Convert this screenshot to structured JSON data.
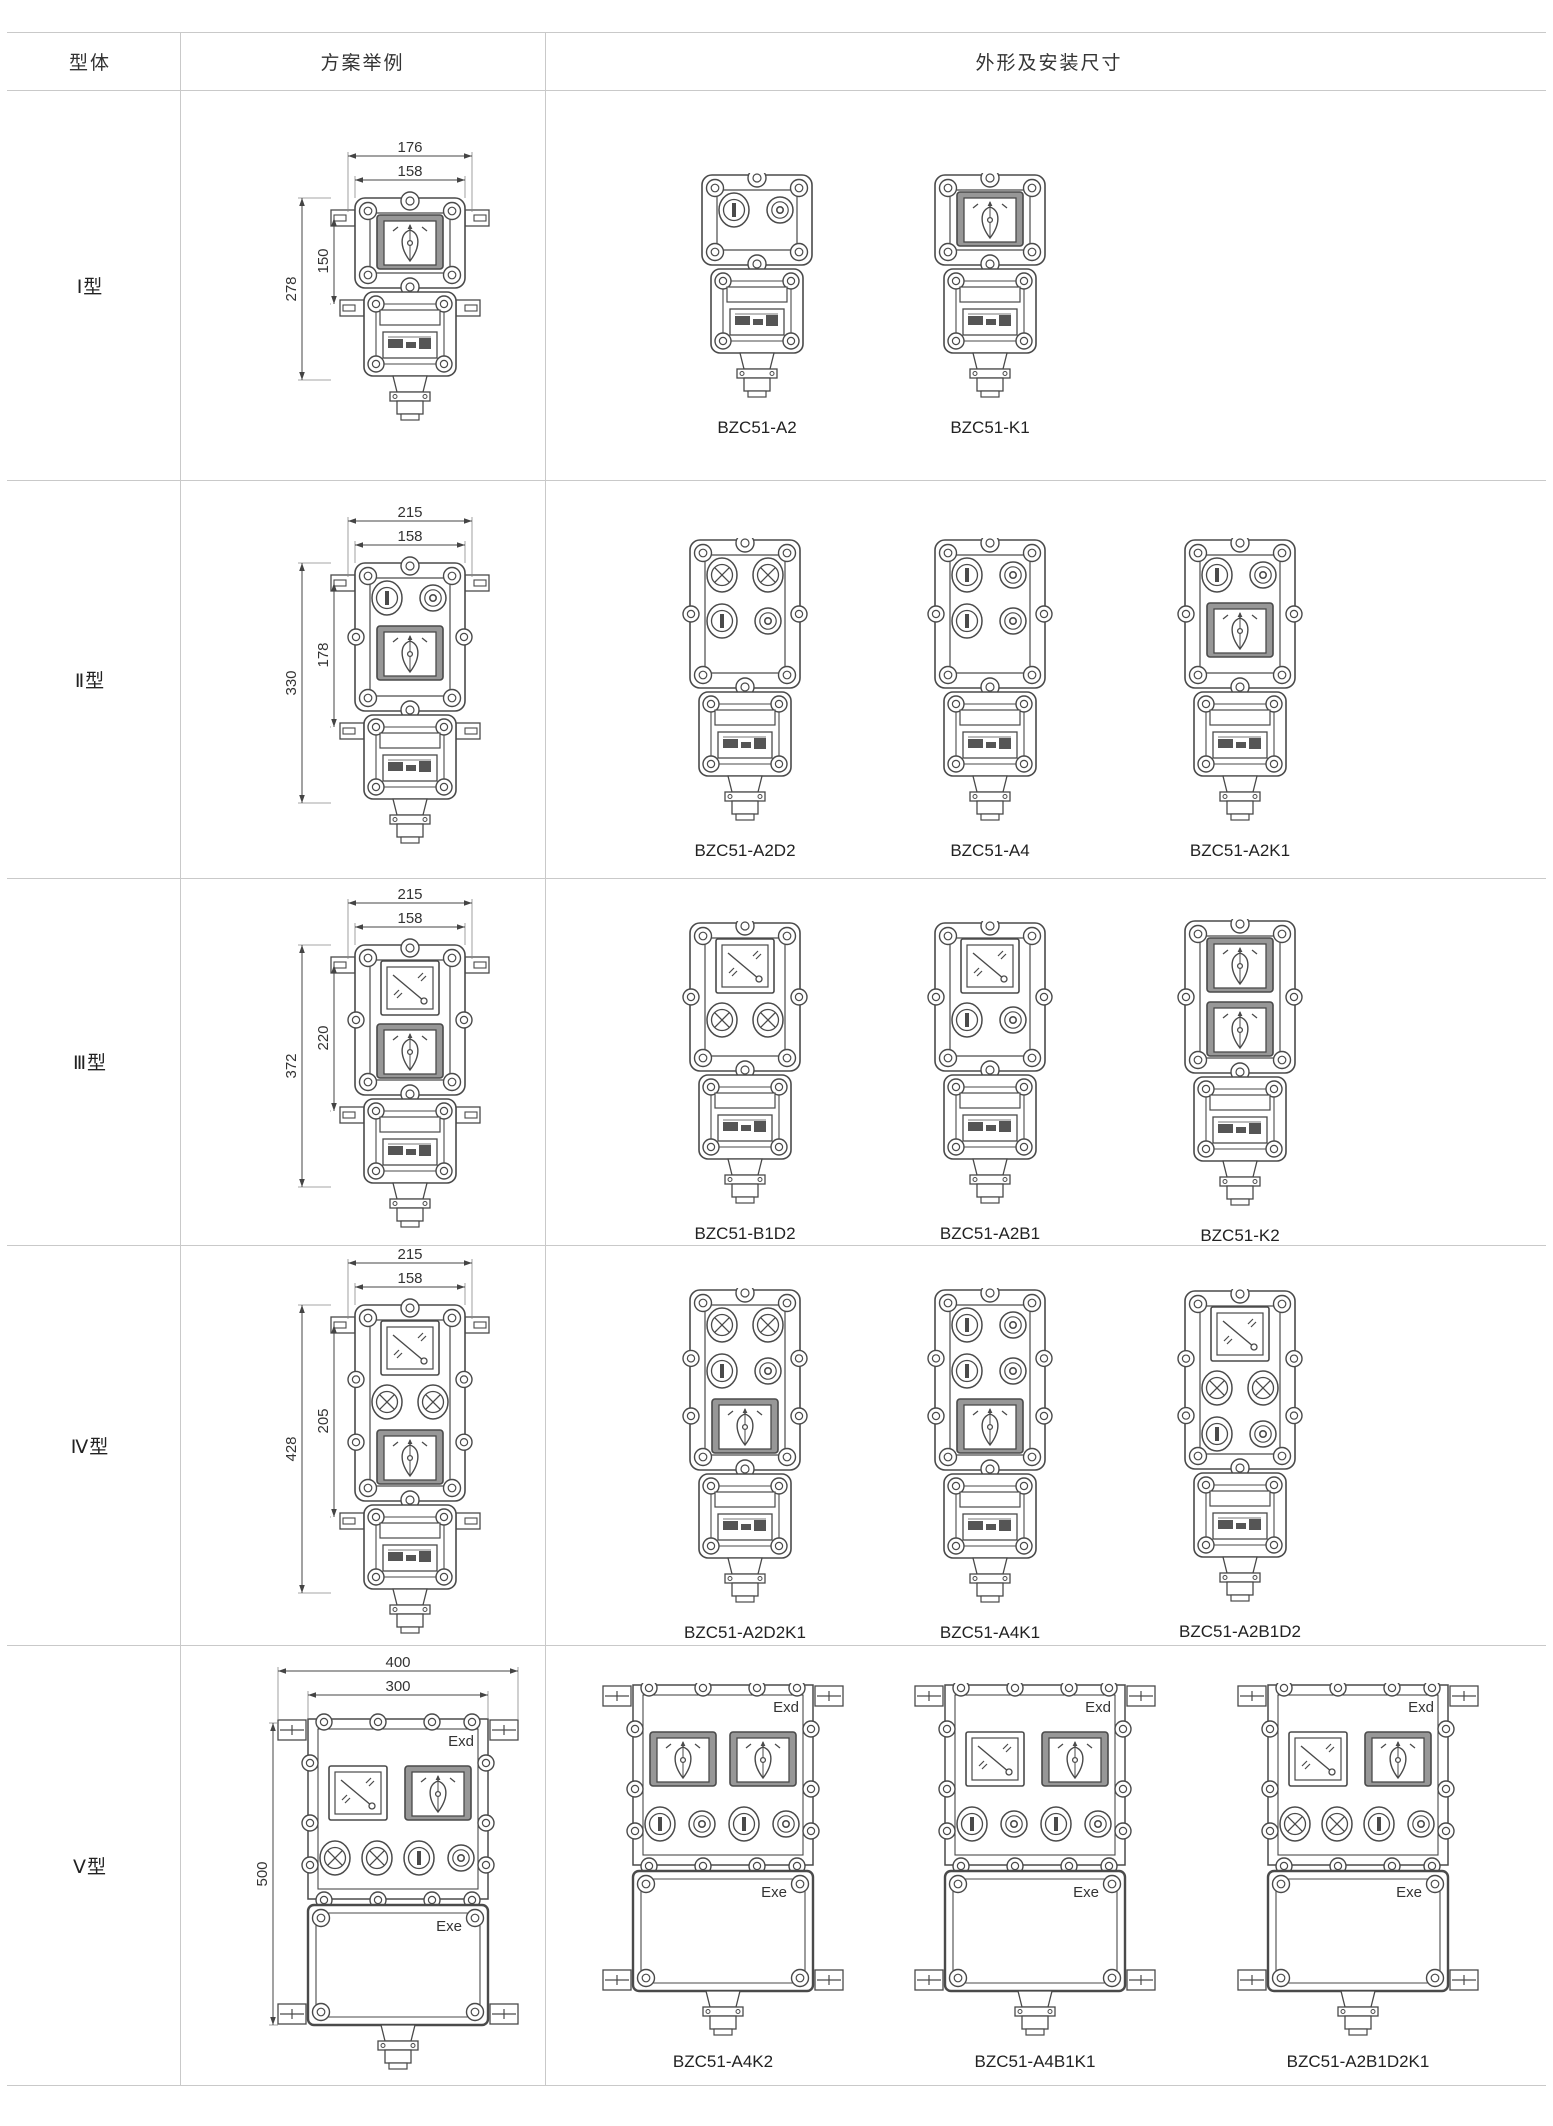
{
  "table": {
    "headers": [
      "型体",
      "方案举例",
      "外形及安装尺寸"
    ],
    "line_color": "#c9c9c9"
  },
  "drawing": {
    "stroke": "#4a4a4a",
    "bezel_fill": "#979797",
    "dim_color": "#444444",
    "labels": {
      "exd": "Exd",
      "exe": "Exe"
    }
  },
  "rows": [
    {
      "type_label": "Ⅰ型",
      "scheme": {
        "kind": "small",
        "rows": [
          [
            "switch"
          ]
        ],
        "dims": {
          "top_outer": "176",
          "top_inner": "158",
          "left_outer": "278",
          "left_inner": "150"
        }
      },
      "variants": [
        {
          "model": "BZC51-A2",
          "kind": "small",
          "rows": [
            [
              "btn1",
              "btn0"
            ]
          ]
        },
        {
          "model": "BZC51-K1",
          "kind": "small",
          "rows": [
            [
              "switch"
            ]
          ]
        }
      ]
    },
    {
      "type_label": "Ⅱ型",
      "scheme": {
        "kind": "small",
        "rows": [
          [
            "btn1",
            "btn0"
          ],
          [
            "switch"
          ]
        ],
        "dims": {
          "top_outer": "215",
          "top_inner": "158",
          "left_outer": "330",
          "left_inner": "178"
        }
      },
      "variants": [
        {
          "model": "BZC51-A2D2",
          "kind": "small",
          "rows": [
            [
              "lamp",
              "lamp"
            ],
            [
              "btn1",
              "btn0"
            ]
          ]
        },
        {
          "model": "BZC51-A4",
          "kind": "small",
          "rows": [
            [
              "btn1",
              "btn0"
            ],
            [
              "btn1",
              "btn0"
            ]
          ]
        },
        {
          "model": "BZC51-A2K1",
          "kind": "small",
          "rows": [
            [
              "btn1",
              "btn0"
            ],
            [
              "switch"
            ]
          ]
        }
      ]
    },
    {
      "type_label": "Ⅲ型",
      "scheme": {
        "kind": "small",
        "rows": [
          [
            "meter"
          ],
          [
            "switch"
          ]
        ],
        "dims": {
          "top_outer": "215",
          "top_inner": "158",
          "left_outer": "372",
          "left_inner": "220"
        }
      },
      "variants": [
        {
          "model": "BZC51-B1D2",
          "kind": "small",
          "rows": [
            [
              "meter"
            ],
            [
              "lamp",
              "lamp"
            ]
          ]
        },
        {
          "model": "BZC51-A2B1",
          "kind": "small",
          "rows": [
            [
              "meter"
            ],
            [
              "btn1",
              "btn0"
            ]
          ]
        },
        {
          "model": "BZC51-K2",
          "kind": "small",
          "rows": [
            [
              "switch"
            ],
            [
              "switch"
            ]
          ]
        }
      ]
    },
    {
      "type_label": "Ⅳ型",
      "scheme": {
        "kind": "small",
        "rows": [
          [
            "meter"
          ],
          [
            "lamp",
            "lamp"
          ],
          [
            "switch"
          ]
        ],
        "dims": {
          "top_outer": "215",
          "top_inner": "158",
          "left_outer": "428",
          "left_inner": "205"
        }
      },
      "variants": [
        {
          "model": "BZC51-A2D2K1",
          "kind": "small",
          "rows": [
            [
              "lamp",
              "lamp"
            ],
            [
              "btn1",
              "btn0"
            ],
            [
              "switch"
            ]
          ]
        },
        {
          "model": "BZC51-A4K1",
          "kind": "small",
          "rows": [
            [
              "btn1",
              "btn0"
            ],
            [
              "btn1",
              "btn0"
            ],
            [
              "switch"
            ]
          ]
        },
        {
          "model": "BZC51-A2B1D2",
          "kind": "small",
          "rows": [
            [
              "meter"
            ],
            [
              "lamp",
              "lamp"
            ],
            [
              "btn1",
              "btn0"
            ]
          ]
        }
      ]
    },
    {
      "type_label": "Ⅴ型",
      "scheme": {
        "kind": "large",
        "top_row": [
          "meter",
          "switch"
        ],
        "btn_row": [
          "lamp",
          "lamp",
          "btn1",
          "btn0"
        ],
        "dims": {
          "top_outer": "400",
          "top_inner": "300",
          "left_outer": "500"
        }
      },
      "variants": [
        {
          "model": "BZC51-A4K2",
          "kind": "large",
          "top_row": [
            "switch",
            "switch"
          ],
          "btn_row": [
            "btn1",
            "btn0",
            "btn1",
            "btn0"
          ]
        },
        {
          "model": "BZC51-A4B1K1",
          "kind": "large",
          "top_row": [
            "meter",
            "switch"
          ],
          "btn_row": [
            "btn1",
            "btn0",
            "btn1",
            "btn0"
          ]
        },
        {
          "model": "BZC51-A2B1D2K1",
          "kind": "large",
          "top_row": [
            "meter",
            "switch"
          ],
          "btn_row": [
            "lamp",
            "lamp",
            "btn1",
            "btn0"
          ]
        }
      ]
    }
  ]
}
